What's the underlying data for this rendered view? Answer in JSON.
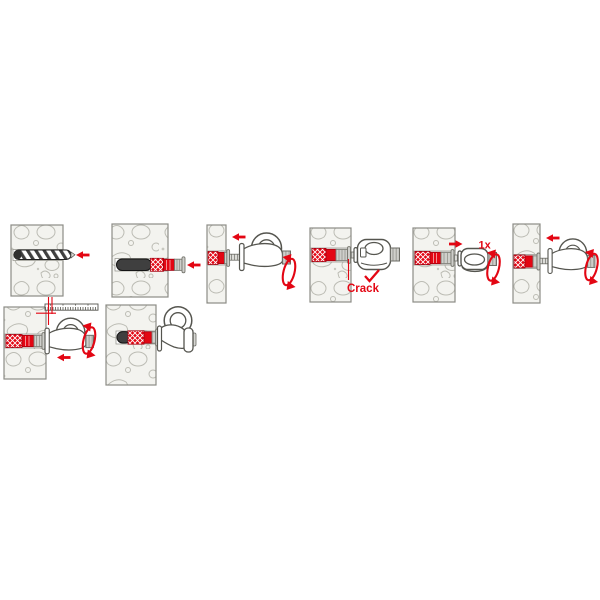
{
  "canvas": {
    "width": 600,
    "height": 600,
    "background": "#ffffff"
  },
  "colors": {
    "accent_red": "#e30613",
    "wall_fill": "#f3f3ef",
    "wall_outline": "#8c8c86",
    "stone_outline": "#bcbcb4",
    "anchor_dark": "#3f3f3f",
    "anchor_red": "#e30613",
    "metal_light": "#cfcfcb",
    "outline_gray": "#55554f"
  },
  "diagram": {
    "name": "expansion-anchor-eye-hook-installation",
    "steps": [
      {
        "name": "drill-hole",
        "label": "",
        "icons": [
          "wall-block",
          "drill-bit",
          "arrow-left"
        ]
      },
      {
        "name": "insert-anchor",
        "label": "",
        "icons": [
          "wall-block",
          "expansion-anchor",
          "arrow-left"
        ]
      },
      {
        "name": "screw-in-eye-hook",
        "label": "",
        "icons": [
          "wall-section",
          "expansion-anchor",
          "eye-hook",
          "arrow-left",
          "rotate-clockwise"
        ]
      },
      {
        "name": "collar-cracks",
        "label": "Crack",
        "icons": [
          "wall-block",
          "expansion-anchor",
          "eye-hook-top-view",
          "callout-line",
          "checkmark"
        ]
      },
      {
        "name": "turn-back-once",
        "label": "1x",
        "icons": [
          "wall-block",
          "expansion-anchor",
          "eye-hook-back-view",
          "arrow-right",
          "rotate-clockwise"
        ]
      },
      {
        "name": "retighten-eye-hook",
        "label": "",
        "icons": [
          "wall-section",
          "expansion-anchor",
          "eye-hook",
          "arrow-left",
          "rotate-clockwise"
        ]
      },
      {
        "name": "set-to-depth",
        "label": "",
        "icons": [
          "wall-block",
          "depth-ruler",
          "expansion-anchor",
          "eye-hook",
          "arrow-left",
          "rotate-clockwise"
        ]
      },
      {
        "name": "installed",
        "label": "",
        "icons": [
          "wall-block",
          "expansion-anchor",
          "eye-hook"
        ]
      }
    ]
  }
}
